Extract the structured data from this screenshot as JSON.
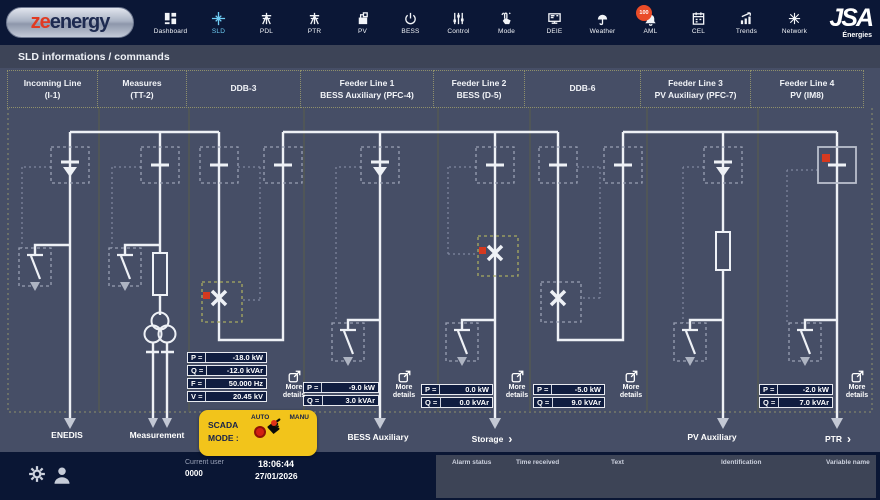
{
  "brand": {
    "logo_ze": "ze",
    "logo_energy": "energy",
    "company": "JSA",
    "company_sub": "Énergies"
  },
  "nav": {
    "items": [
      {
        "label": "Dashboard"
      },
      {
        "label": "SLD",
        "active": true
      },
      {
        "label": "PDL"
      },
      {
        "label": "PTR"
      },
      {
        "label": "PV"
      },
      {
        "label": "BESS"
      },
      {
        "label": "Control"
      },
      {
        "label": "Mode"
      },
      {
        "label": "DEIE"
      },
      {
        "label": "Weather"
      },
      {
        "label": "AML",
        "badge": "100"
      },
      {
        "label": "CEL"
      },
      {
        "label": "Trends"
      },
      {
        "label": "Network"
      }
    ]
  },
  "page": {
    "title": "SLD informations / commands"
  },
  "columns": [
    {
      "line1": "Incoming Line",
      "line2": "(I-1)"
    },
    {
      "line1": "Measures",
      "line2": "(TT-2)"
    },
    {
      "line1": "DDB-3",
      "line2": ""
    },
    {
      "line1": "Feeder Line 1",
      "line2": "BESS Auxiliary (PFC-4)"
    },
    {
      "line1": "Feeder Line 2",
      "line2": "BESS (D-5)"
    },
    {
      "line1": "DDB-6",
      "line2": ""
    },
    {
      "line1": "Feeder Line 3",
      "line2": "PV Auxiliary (PFC-7)"
    },
    {
      "line1": "Feeder Line 4",
      "line2": "PV (IM8)"
    }
  ],
  "panels": {
    "ddb3": [
      {
        "label": "P =",
        "value": "-18.0 kW"
      },
      {
        "label": "Q =",
        "value": "-12.0 kVAr"
      },
      {
        "label": "F =",
        "value": "50.000 Hz"
      },
      {
        "label": "V =",
        "value": "20.45 kV"
      }
    ],
    "feeder1": [
      {
        "label": "P =",
        "value": "-9.0 kW"
      },
      {
        "label": "Q =",
        "value": "3.0 kVAr"
      }
    ],
    "feeder2": [
      {
        "label": "P =",
        "value": "0.0 kW"
      },
      {
        "label": "Q =",
        "value": "0.0 kVAr"
      }
    ],
    "ddb6": [
      {
        "label": "P =",
        "value": "-5.0 kW"
      },
      {
        "label": "Q =",
        "value": "9.0 kVAr"
      }
    ],
    "feeder4": [
      {
        "label": "P =",
        "value": "-2.0 kW"
      },
      {
        "label": "Q =",
        "value": "7.0 kVAr"
      }
    ]
  },
  "labels": {
    "more_details": "More details"
  },
  "scada": {
    "label": "SCADA\nMODE :",
    "auto": "AUTO",
    "manu": "MANU"
  },
  "bottom_labels": {
    "enedis": "ENEDIS",
    "measurement": "Measurement",
    "bess_aux": "BESS Auxiliary",
    "storage": "Storage",
    "pv_aux": "PV Auxiliary",
    "ptr": "PTR"
  },
  "icons": {
    "chevron": "›",
    "hand": "☛"
  },
  "footer": {
    "current_user_label": "Current user",
    "current_user_id": "0000",
    "time": "18:06:44",
    "date": "27/01/2026",
    "alarm_headers": [
      "Alarm status",
      "Time received",
      "Text",
      "Identification",
      "Variable name"
    ]
  },
  "colors": {
    "navbar_bg": "#0b1736",
    "diagram_bg": "#464e66",
    "accent_cyan": "#6fcdf4",
    "alert_red": "#d5391f",
    "scada_yellow": "#f2c41b",
    "line_white": "#eef1f6",
    "cell_border_olive": "#8f906b",
    "badge_orange": "#ea4c28"
  }
}
